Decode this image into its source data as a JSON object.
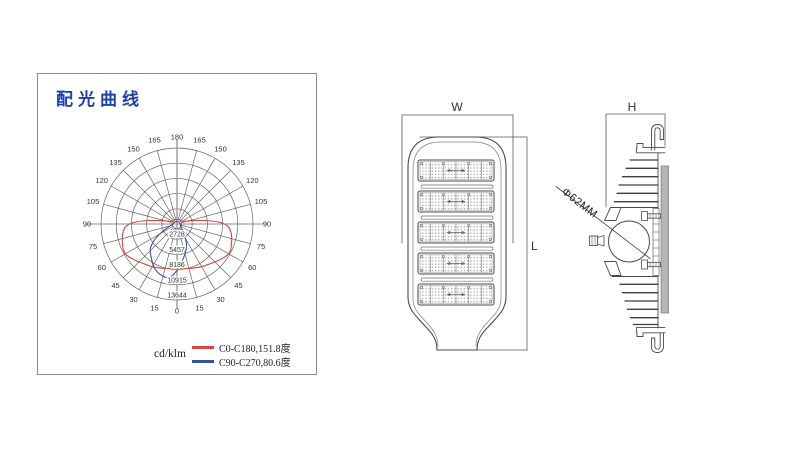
{
  "panel": {
    "title": "配光曲线"
  },
  "chart_data": {
    "type": "polar_line",
    "title": "配光曲线",
    "units": "cd/klm",
    "angle_ticks_deg": [
      0,
      15,
      30,
      45,
      60,
      75,
      90,
      105,
      120,
      135,
      150,
      165,
      180
    ],
    "ring_values": [
      2728,
      5457,
      8186,
      10915,
      13644
    ],
    "max_value": 13644,
    "legend_position": "bottom",
    "series": [
      {
        "name": "C0-C180,151.8度",
        "beam_angle": "151.8度",
        "color": "#d6453f",
        "points": [
          [
            -180,
            850
          ],
          [
            -160,
            850
          ],
          [
            -140,
            900
          ],
          [
            -120,
            1000
          ],
          [
            -110,
            1400
          ],
          [
            -103,
            2600
          ],
          [
            -97,
            5200
          ],
          [
            -92,
            7800
          ],
          [
            -87,
            9200
          ],
          [
            -80,
            9900
          ],
          [
            -72,
            10300
          ],
          [
            -64,
            10700
          ],
          [
            -58,
            10600
          ],
          [
            -50,
            10000
          ],
          [
            -44,
            9550
          ],
          [
            -37,
            9150
          ],
          [
            -30,
            8850
          ],
          [
            -22,
            8500
          ],
          [
            -15,
            8250
          ],
          [
            -8,
            8050
          ],
          [
            0,
            7900
          ],
          [
            8,
            8050
          ],
          [
            15,
            8250
          ],
          [
            22,
            8500
          ],
          [
            30,
            8850
          ],
          [
            37,
            9150
          ],
          [
            44,
            9550
          ],
          [
            50,
            10000
          ],
          [
            58,
            10600
          ],
          [
            64,
            10700
          ],
          [
            72,
            10300
          ],
          [
            80,
            9900
          ],
          [
            87,
            9200
          ],
          [
            92,
            7800
          ],
          [
            97,
            5200
          ],
          [
            103,
            2600
          ],
          [
            110,
            1400
          ],
          [
            120,
            1000
          ],
          [
            140,
            900
          ],
          [
            160,
            850
          ]
        ]
      },
      {
        "name": "C90-C270,80.6度",
        "beam_angle": "80.6度",
        "color": "#33539f",
        "points": [
          [
            -180,
            480
          ],
          [
            -150,
            500
          ],
          [
            -120,
            560
          ],
          [
            -95,
            650
          ],
          [
            -80,
            950
          ],
          [
            -70,
            1700
          ],
          [
            -62,
            3100
          ],
          [
            -55,
            4900
          ],
          [
            -48,
            6400
          ],
          [
            -42,
            7100
          ],
          [
            -35,
            7900
          ],
          [
            -28,
            8800
          ],
          [
            -21,
            9400
          ],
          [
            -15,
            9700
          ],
          [
            -10,
            9750
          ],
          [
            -4,
            9100
          ],
          [
            2,
            7900
          ],
          [
            8,
            6700
          ],
          [
            14,
            5700
          ],
          [
            20,
            4800
          ],
          [
            26,
            3900
          ],
          [
            32,
            2500
          ],
          [
            40,
            1300
          ],
          [
            55,
            800
          ],
          [
            75,
            620
          ],
          [
            100,
            540
          ],
          [
            130,
            500
          ],
          [
            160,
            480
          ]
        ]
      }
    ]
  },
  "front_view": {
    "width_label": "W",
    "length_label": "L"
  },
  "side_view": {
    "height_label": "H",
    "mount_diameter_label": "Φ62MM"
  }
}
